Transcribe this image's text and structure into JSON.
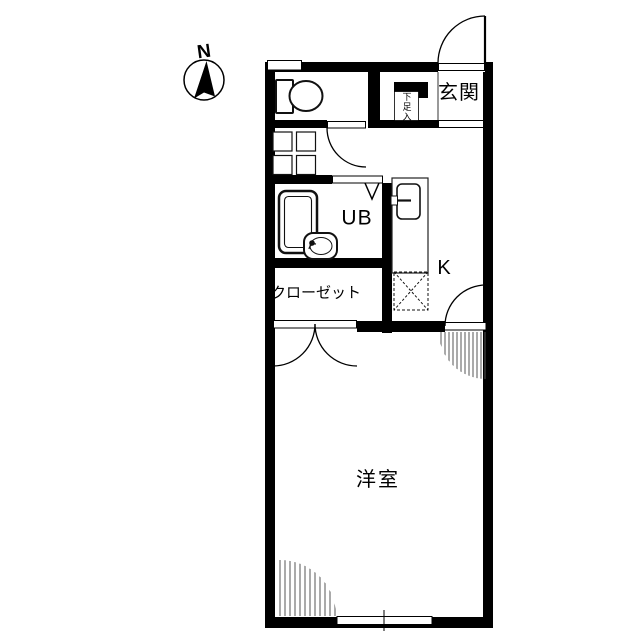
{
  "compass": {
    "north_label": "N"
  },
  "labels": {
    "entrance": "玄関",
    "shoe_storage": "下足入",
    "unit_bath": "UB",
    "kitchen": "K",
    "closet": "クローゼット",
    "western_room": "洋室"
  },
  "colors": {
    "wall": "#000000",
    "background": "#ffffff",
    "fixture_line": "#111111",
    "hatch_line": "#555555"
  }
}
